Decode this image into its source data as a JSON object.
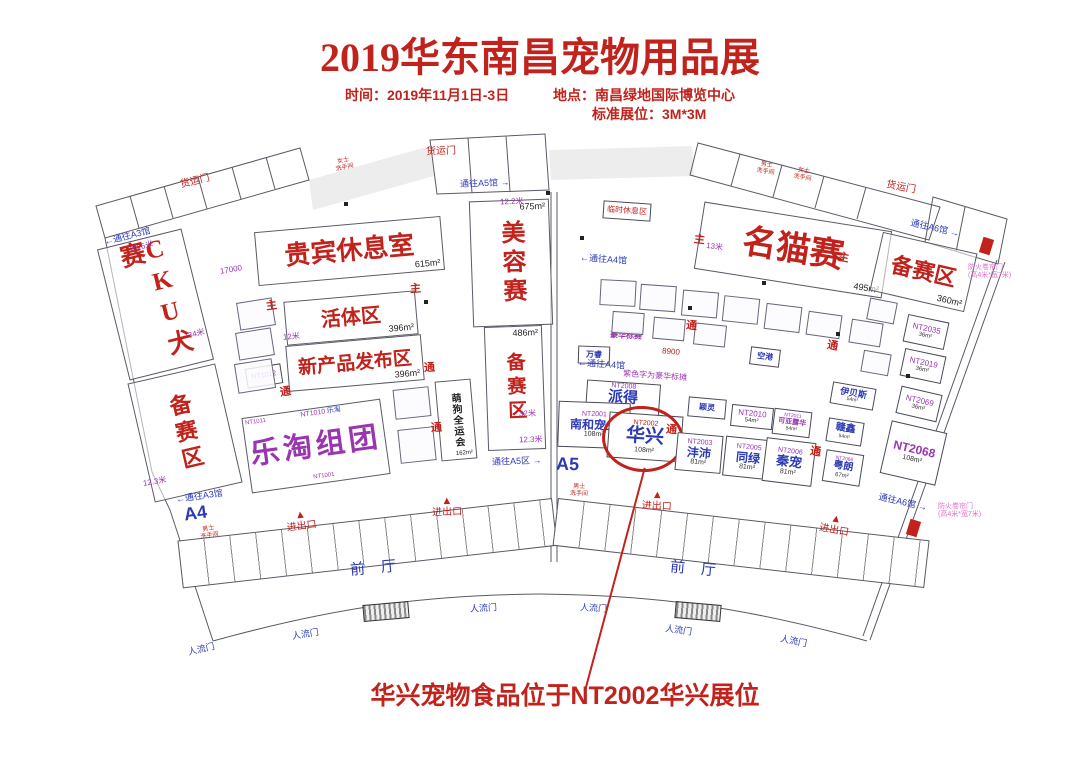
{
  "header": {
    "title": "2019华东南昌宠物用品展",
    "time": "时间：2019年11月1日-3日",
    "place": "地点：南昌绿地国际博览中心",
    "booth_spec": "标准展位：3M*3M"
  },
  "zones": {
    "cku": {
      "name": "CKU犬赛"
    },
    "prep_left": {
      "name": "备赛区"
    },
    "vip": {
      "name": "贵宾休息室",
      "area": "615m²"
    },
    "live": {
      "name": "活体区",
      "area": "396m²"
    },
    "newprod": {
      "name": "新产品发布区",
      "area": "396m²"
    },
    "letao": {
      "name": "乐淘组团"
    },
    "doggames": {
      "name": "萌狗全运会",
      "area": "162m²"
    },
    "beauty": {
      "name": "美容赛",
      "area": "675m²"
    },
    "prep_mid": {
      "name": "备赛区",
      "area": "486m²"
    },
    "cat": {
      "name": "名猫赛",
      "area": "495m²"
    },
    "prep_right": {
      "name": "备赛区",
      "area": "360m²"
    }
  },
  "booths": {
    "paide": {
      "num": "NT2008",
      "name": "派得",
      "area": "126m²"
    },
    "nanhe": {
      "num": "NT2001",
      "name": "南和宠业",
      "area": "108m²"
    },
    "huaxing": {
      "num": "NT2002",
      "name": "华兴",
      "area": "108m²"
    },
    "fengpei": {
      "num": "NT2003",
      "name": "沣沛",
      "area": "81m²"
    },
    "tonglv": {
      "num": "NT2005",
      "name": "同绿",
      "area": "81m²"
    },
    "qinchong": {
      "num": "NT2006",
      "name": "秦宠",
      "area": "81m²"
    },
    "nt2010": {
      "num": "NT2010",
      "area": "54m²"
    },
    "keya": {
      "num": "NT2011",
      "name": "可亚露华",
      "area": "54m²"
    },
    "ganxin": {
      "name": "赣鑫",
      "area": "54m²"
    },
    "yuelang": {
      "num": "NT2066",
      "name": "粤朗",
      "area": "67m²"
    },
    "yibeisi": {
      "name": "伊贝斯",
      "area": "54m²"
    },
    "nt2035": {
      "num": "NT2035",
      "area": "36m²"
    },
    "nt2019": {
      "num": "NT2019",
      "area": "36m²"
    },
    "nt2069": {
      "num": "NT2069",
      "area": "36m²"
    },
    "nt2068": {
      "num": "NT2068",
      "area": "108m²"
    },
    "kongta": {
      "name": "空港"
    },
    "wanrui": {
      "name": "万睿"
    },
    "yingling": {
      "name": "颖灵"
    },
    "haohua": {
      "name": "豪华标赛"
    },
    "xiuxi": {
      "name": "临时休息区"
    },
    "nt1010": {
      "num": "NT1010",
      "name": "乐淘"
    },
    "nt1011": {
      "num": "NT1011"
    },
    "nt1001": {
      "num": "NT1001"
    },
    "nt1012": {
      "num": "NT1012"
    }
  },
  "labels": {
    "hall_a4": "A4",
    "hall_a5": "A5",
    "front_hall": "前厅",
    "cargo_door": "货运门",
    "people_door": "人流门",
    "entrance": "进出口",
    "to_a3": "通往A3馆",
    "to_a4": "通往A4馆",
    "to_a5_hall": "通往A5馆",
    "to_a5_zone": "通往A5区",
    "to_a6": "通往A6馆",
    "fire_door_line1": "防火卷帘门",
    "fire_door_line2": "(高4米*宽7米)",
    "male": "男士",
    "female": "女士",
    "washroom": "洗手间",
    "main_aisle": "主",
    "aisle": "通",
    "purple_note": "紫色字为豪华标摊",
    "arrow_left": "←",
    "arrow_right": "→",
    "arrow_up": "▲"
  },
  "dims": {
    "d17000": "17000",
    "d23_6": "23.6米",
    "d34": "34米",
    "d12": "12米",
    "d12_3": "12.3米",
    "d8900": "8900",
    "d12_2": "12.2米",
    "d32": "32米",
    "d13": "13米"
  },
  "annotation": {
    "text": "华兴宠物食品位于NT2002华兴展位"
  }
}
